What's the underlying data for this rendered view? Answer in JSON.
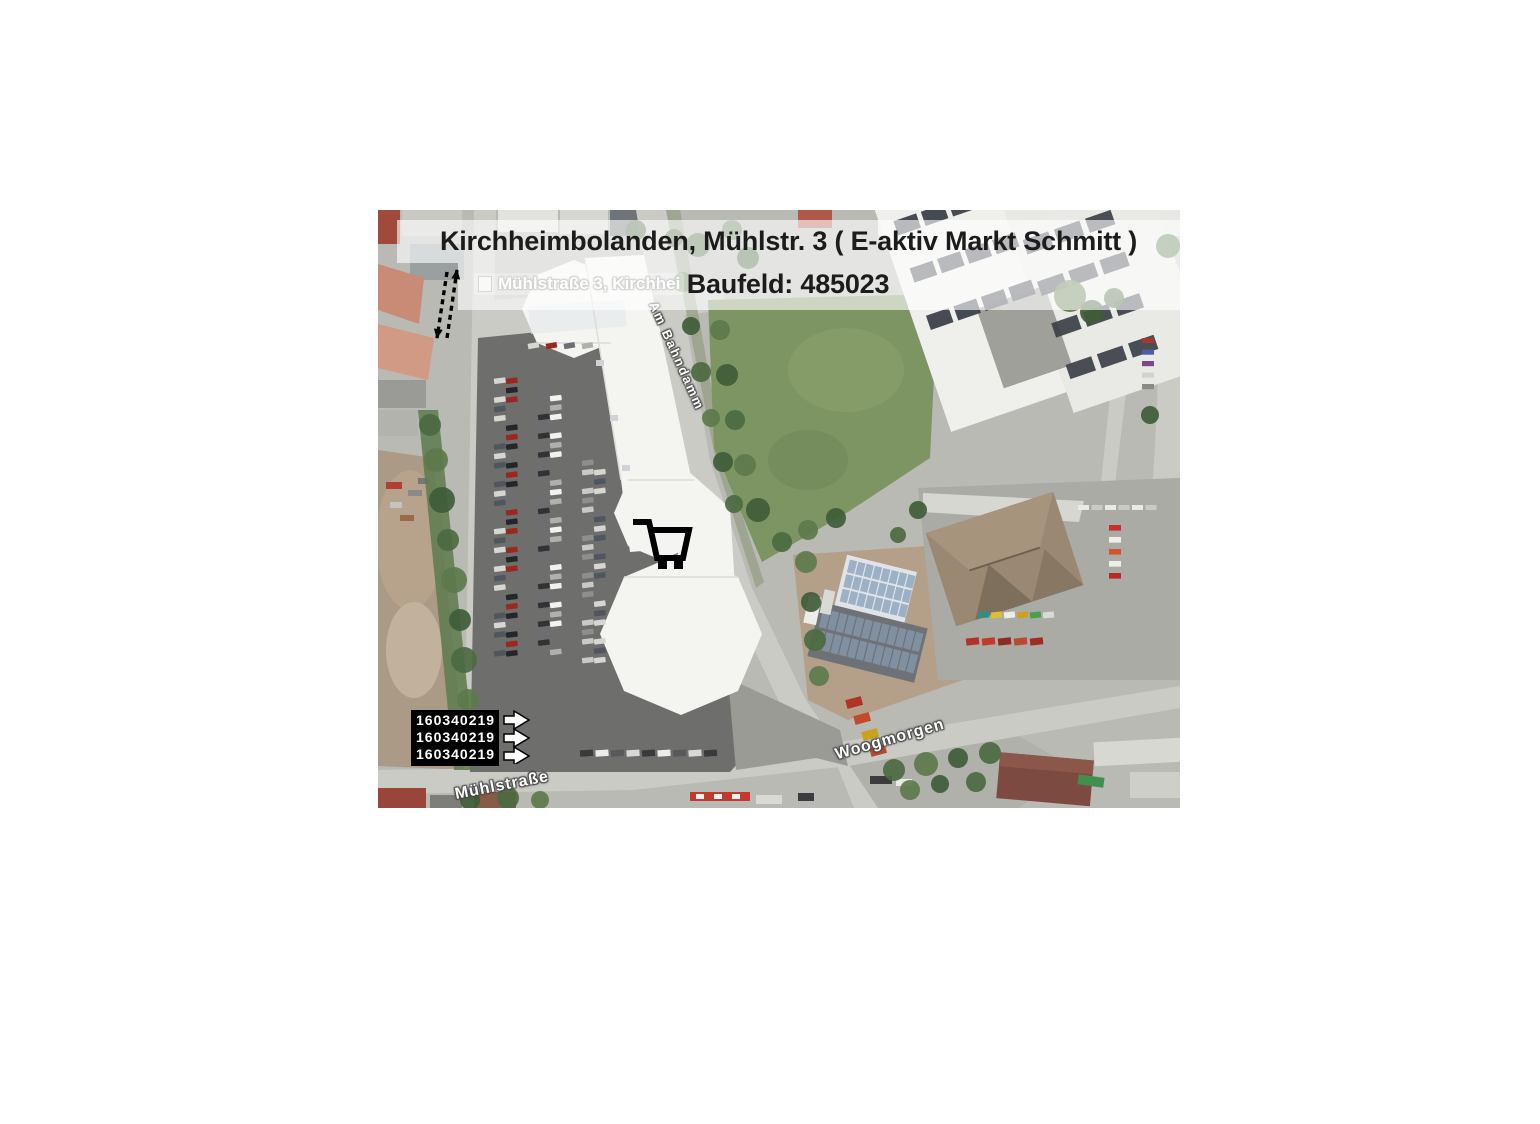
{
  "slide": {
    "background": "#ffffff"
  },
  "map": {
    "title": "Kirchheimbolanden, Mühlstr. 3 ( E-aktiv Markt Schmitt )",
    "subtitle": "Baufeld: 485023",
    "address_label": "Mühlstraße 3, Kirchhei",
    "streets": [
      {
        "label": "Am Bahndamm"
      },
      {
        "label": "Woogmorgen"
      },
      {
        "label": "Mühlstraße"
      }
    ],
    "parcel_ids": [
      "160340219",
      "160340219",
      "160340219"
    ],
    "icons": {
      "store_marker": "shopping-cart-icon",
      "parcel_pointer": "arrow-right-icon",
      "distance_marker": "dashed-double-arrow-icon"
    },
    "colors": {
      "banner_overlay": "rgba(255,255,255,0.62)",
      "title_text": "#1c1c1c",
      "street_label_text": "#ffffff",
      "parcel_box_bg": "#000000",
      "parcel_text": "#ffffff",
      "field_green": "#7d9463",
      "parking_asphalt": "#6e6e6c",
      "market_roof_white": "#f4f4f1",
      "dealership_roof_brown": "#9a8872",
      "road_gray": "#cbcbc6"
    }
  }
}
